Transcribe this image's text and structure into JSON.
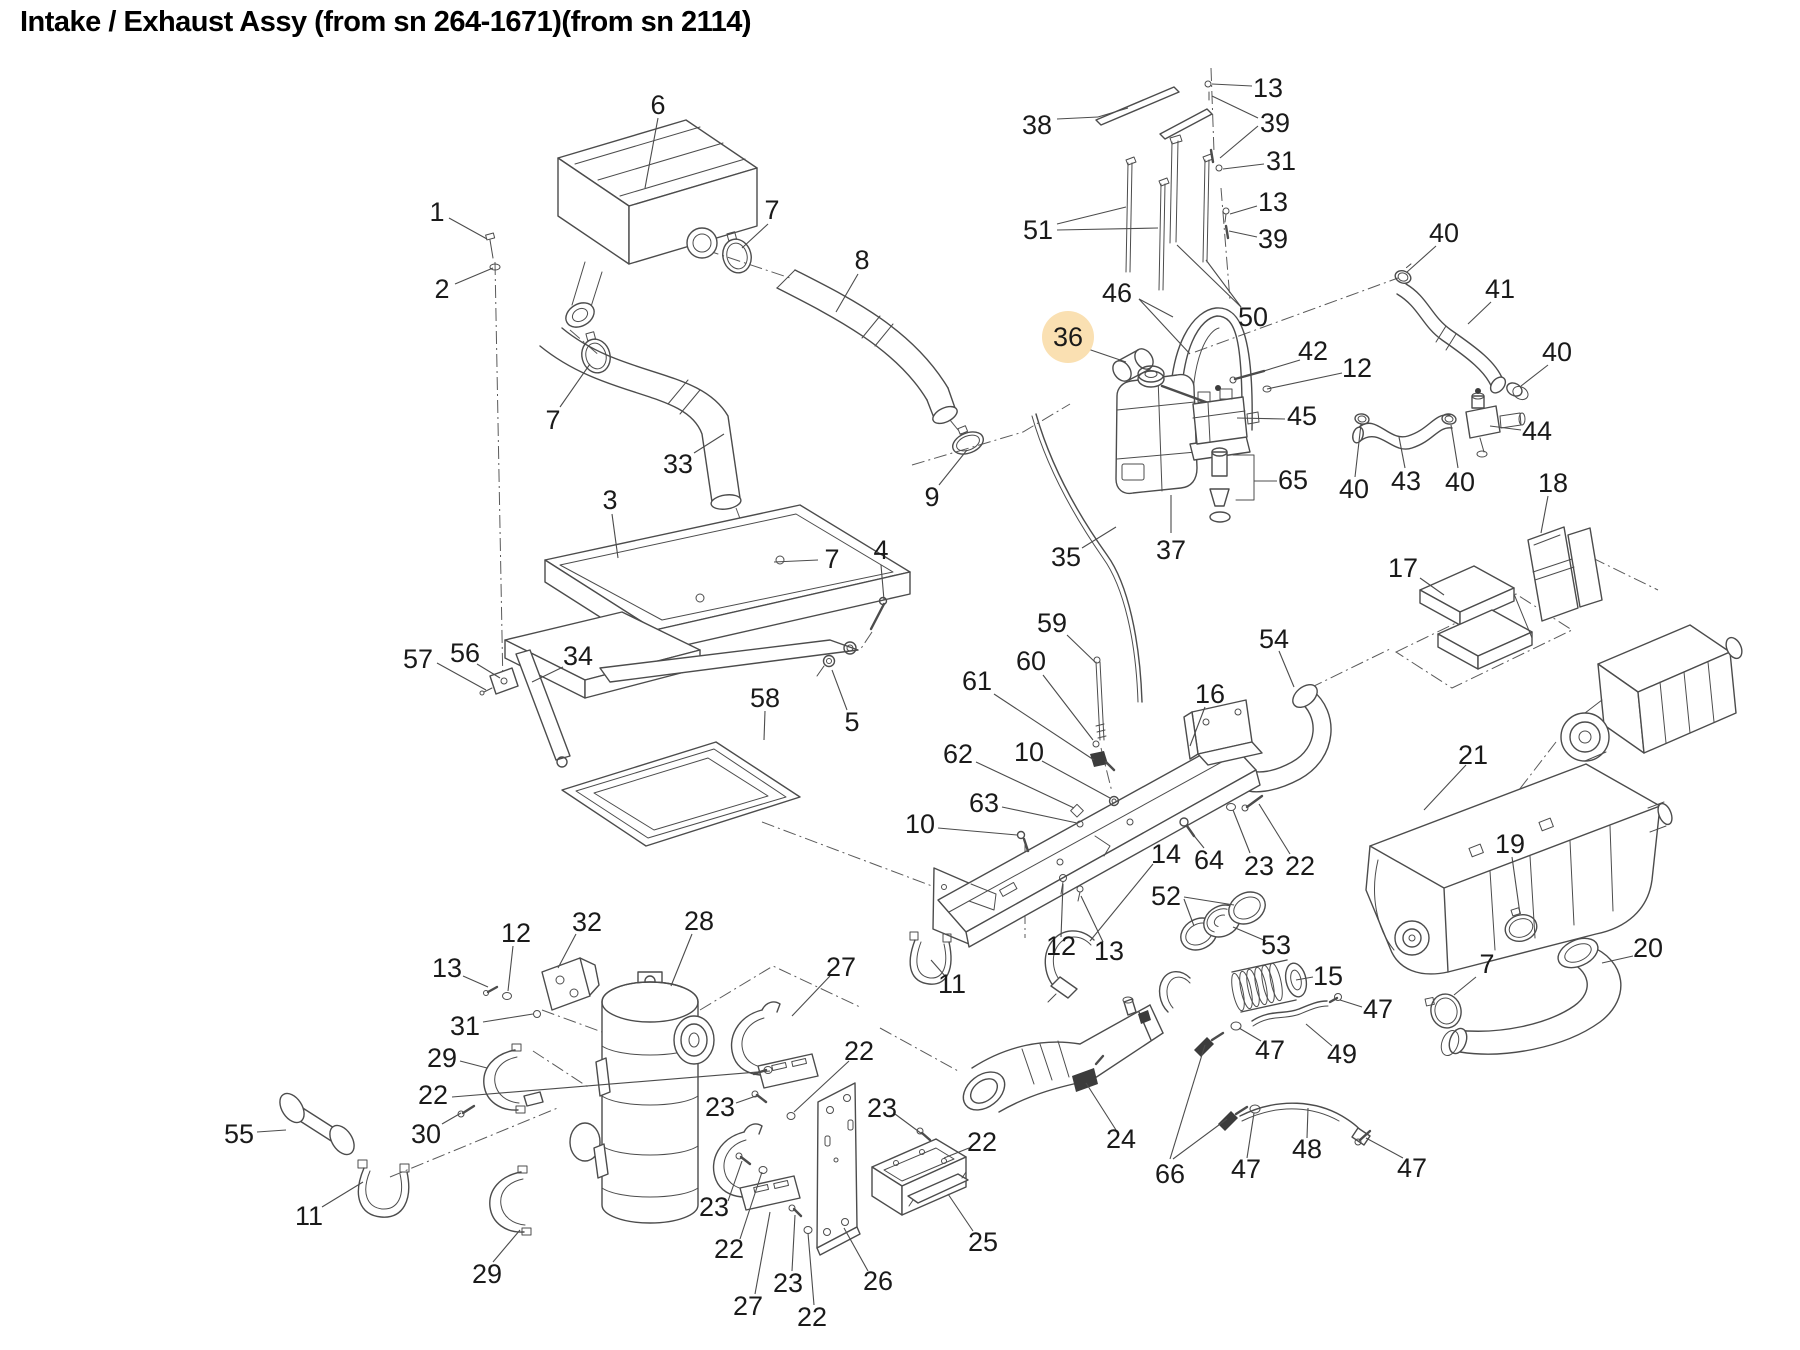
{
  "title": "Intake / Exhaust Assy (from sn 264-1671)(from sn 2114)",
  "colors": {
    "background": "#ffffff",
    "line_art": "#4c4c4c",
    "label_text": "#1a1a1a",
    "highlight_fill": "#fae0b2",
    "highlight_text": "#5d5e64"
  },
  "highlight": {
    "radius": 26
  },
  "callouts": [
    {
      "text": "6",
      "x": 658,
      "y": 105,
      "leaders": [
        [
          658,
          118,
          645,
          188
        ]
      ]
    },
    {
      "text": "1",
      "x": 437,
      "y": 212,
      "leaders": [
        [
          449,
          218,
          487,
          239
        ]
      ]
    },
    {
      "text": "2",
      "x": 442,
      "y": 289,
      "leaders": [
        [
          455,
          284,
          493,
          268
        ]
      ]
    },
    {
      "text": "7",
      "x": 772,
      "y": 210,
      "leaders": [
        [
          768,
          224,
          742,
          248
        ]
      ]
    },
    {
      "text": "8",
      "x": 862,
      "y": 260,
      "leaders": [
        [
          858,
          274,
          836,
          312
        ]
      ]
    },
    {
      "text": "7",
      "x": 553,
      "y": 420,
      "leaders": [
        [
          560,
          407,
          590,
          364
        ]
      ]
    },
    {
      "text": "33",
      "x": 678,
      "y": 464,
      "leaders": [
        [
          694,
          453,
          724,
          434
        ]
      ]
    },
    {
      "text": "3",
      "x": 610,
      "y": 500,
      "leaders": [
        [
          612,
          514,
          618,
          558
        ]
      ]
    },
    {
      "text": "57",
      "x": 418,
      "y": 659,
      "leaders": [
        [
          437,
          663,
          486,
          690
        ]
      ]
    },
    {
      "text": "56",
      "x": 465,
      "y": 653,
      "leaders": [
        [
          477,
          664,
          500,
          678
        ]
      ]
    },
    {
      "text": "34",
      "x": 578,
      "y": 656,
      "leaders": [
        [
          563,
          667,
          532,
          682
        ]
      ]
    },
    {
      "text": "58",
      "x": 765,
      "y": 698,
      "leaders": [
        [
          765,
          711,
          764,
          740
        ]
      ]
    },
    {
      "text": "5",
      "x": 852,
      "y": 722,
      "leaders": [
        [
          847,
          710,
          832,
          670
        ]
      ]
    },
    {
      "text": "4",
      "x": 881,
      "y": 550,
      "leaders": [
        [
          881,
          565,
          884,
          600
        ]
      ]
    },
    {
      "text": "7",
      "x": 832,
      "y": 559,
      "leaders": [
        [
          818,
          560,
          774,
          562
        ]
      ]
    },
    {
      "text": "9",
      "x": 932,
      "y": 497,
      "leaders": [
        [
          939,
          485,
          967,
          450
        ]
      ]
    },
    {
      "text": "38",
      "x": 1037,
      "y": 125,
      "leaders": [
        [
          1057,
          119,
          1098,
          117
        ],
        [
          1098,
          117,
          1128,
          108
        ]
      ]
    },
    {
      "text": "13",
      "x": 1268,
      "y": 88,
      "leaders": [
        [
          1252,
          86,
          1212,
          84
        ]
      ]
    },
    {
      "text": "39",
      "x": 1275,
      "y": 123,
      "leaders": [
        [
          1258,
          118,
          1212,
          96
        ],
        [
          1258,
          126,
          1220,
          158
        ]
      ]
    },
    {
      "text": "31",
      "x": 1281,
      "y": 161,
      "leaders": [
        [
          1264,
          164,
          1223,
          169
        ]
      ]
    },
    {
      "text": "13",
      "x": 1273,
      "y": 202,
      "leaders": [
        [
          1257,
          206,
          1230,
          214
        ]
      ]
    },
    {
      "text": "39",
      "x": 1273,
      "y": 239,
      "leaders": [
        [
          1257,
          237,
          1229,
          231
        ]
      ]
    },
    {
      "text": "51",
      "x": 1038,
      "y": 230,
      "leaders": [
        [
          1057,
          224,
          1126,
          207
        ],
        [
          1057,
          230,
          1158,
          228
        ]
      ]
    },
    {
      "text": "46",
      "x": 1117,
      "y": 293,
      "leaders": [
        [
          1139,
          299,
          1173,
          317
        ],
        [
          1139,
          299,
          1190,
          354
        ]
      ]
    },
    {
      "text": "50",
      "x": 1253,
      "y": 317,
      "leaders": [
        [
          1241,
          307,
          1206,
          260
        ],
        [
          1241,
          307,
          1177,
          245
        ]
      ]
    },
    {
      "text": "36",
      "x": 1068,
      "y": 337,
      "highlight": true,
      "leaders": [
        [
          1082,
          347,
          1126,
          362
        ]
      ]
    },
    {
      "text": "42",
      "x": 1313,
      "y": 351,
      "leaders": [
        [
          1300,
          360,
          1244,
          377
        ]
      ]
    },
    {
      "text": "12",
      "x": 1357,
      "y": 368,
      "leaders": [
        [
          1342,
          373,
          1267,
          389
        ]
      ]
    },
    {
      "text": "45",
      "x": 1302,
      "y": 416,
      "leaders": [
        [
          1285,
          419,
          1237,
          418
        ]
      ]
    },
    {
      "text": "65",
      "x": 1293,
      "y": 480,
      "leaders": [
        [
          1277,
          481,
          1254,
          481
        ]
      ]
    },
    {
      "text": "40",
      "x": 1354,
      "y": 489,
      "leaders": [
        [
          1355,
          477,
          1361,
          424
        ]
      ]
    },
    {
      "text": "35",
      "x": 1066,
      "y": 557,
      "leaders": [
        [
          1082,
          548,
          1116,
          527
        ]
      ]
    },
    {
      "text": "37",
      "x": 1171,
      "y": 550,
      "leaders": [
        [
          1171,
          533,
          1171,
          495
        ]
      ]
    },
    {
      "text": "40",
      "x": 1444,
      "y": 233,
      "leaders": [
        [
          1436,
          246,
          1407,
          272
        ]
      ]
    },
    {
      "text": "41",
      "x": 1500,
      "y": 289,
      "leaders": [
        [
          1491,
          302,
          1468,
          324
        ]
      ]
    },
    {
      "text": "40",
      "x": 1557,
      "y": 352,
      "leaders": [
        [
          1548,
          365,
          1521,
          386
        ]
      ]
    },
    {
      "text": "44",
      "x": 1537,
      "y": 431,
      "leaders": [
        [
          1521,
          430,
          1490,
          426
        ]
      ]
    },
    {
      "text": "43",
      "x": 1406,
      "y": 481,
      "leaders": [
        [
          1405,
          468,
          1399,
          437
        ]
      ]
    },
    {
      "text": "40",
      "x": 1460,
      "y": 482,
      "leaders": [
        [
          1458,
          468,
          1451,
          425
        ]
      ]
    },
    {
      "text": "17",
      "x": 1403,
      "y": 568,
      "leaders": [
        [
          1420,
          578,
          1444,
          595
        ]
      ]
    },
    {
      "text": "18",
      "x": 1553,
      "y": 483,
      "leaders": [
        [
          1548,
          496,
          1541,
          533
        ]
      ]
    },
    {
      "text": "54",
      "x": 1274,
      "y": 639,
      "leaders": [
        [
          1279,
          651,
          1294,
          687
        ]
      ]
    },
    {
      "text": "21",
      "x": 1473,
      "y": 755,
      "leaders": [
        [
          1466,
          765,
          1424,
          810
        ]
      ]
    },
    {
      "text": "19",
      "x": 1510,
      "y": 844,
      "leaders": [
        [
          1512,
          857,
          1520,
          914
        ]
      ]
    },
    {
      "text": "20",
      "x": 1648,
      "y": 948,
      "leaders": [
        [
          1633,
          956,
          1602,
          963
        ]
      ]
    },
    {
      "text": "7",
      "x": 1487,
      "y": 964,
      "leaders": [
        [
          1476,
          977,
          1454,
          995
        ]
      ]
    },
    {
      "text": "47",
      "x": 1378,
      "y": 1009,
      "leaders": [
        [
          1362,
          1007,
          1340,
          1000
        ]
      ]
    },
    {
      "text": "15",
      "x": 1328,
      "y": 976,
      "leaders": [
        [
          1313,
          977,
          1296,
          980
        ]
      ]
    },
    {
      "text": "49",
      "x": 1342,
      "y": 1054,
      "leaders": [
        [
          1332,
          1046,
          1306,
          1024
        ]
      ]
    },
    {
      "text": "47",
      "x": 1270,
      "y": 1050,
      "leaders": [
        [
          1261,
          1041,
          1239,
          1028
        ]
      ]
    },
    {
      "text": "24",
      "x": 1121,
      "y": 1139,
      "leaders": [
        [
          1116,
          1130,
          1086,
          1083
        ]
      ]
    },
    {
      "text": "66",
      "x": 1170,
      "y": 1174,
      "leaders": [
        [
          1170,
          1159,
          1205,
          1045
        ],
        [
          1173,
          1159,
          1227,
          1119
        ]
      ]
    },
    {
      "text": "47",
      "x": 1246,
      "y": 1169,
      "leaders": [
        [
          1247,
          1158,
          1254,
          1113
        ]
      ]
    },
    {
      "text": "48",
      "x": 1307,
      "y": 1149,
      "leaders": [
        [
          1307,
          1138,
          1308,
          1108
        ]
      ]
    },
    {
      "text": "47",
      "x": 1412,
      "y": 1168,
      "leaders": [
        [
          1403,
          1158,
          1366,
          1138
        ]
      ]
    },
    {
      "text": "59",
      "x": 1052,
      "y": 623,
      "leaders": [
        [
          1067,
          635,
          1095,
          662
        ]
      ]
    },
    {
      "text": "60",
      "x": 1031,
      "y": 661,
      "leaders": [
        [
          1043,
          675,
          1093,
          740
        ]
      ]
    },
    {
      "text": "61",
      "x": 977,
      "y": 681,
      "leaders": [
        [
          994,
          694,
          1094,
          760
        ]
      ]
    },
    {
      "text": "16",
      "x": 1210,
      "y": 694,
      "leaders": [
        [
          1205,
          707,
          1190,
          746
        ]
      ]
    },
    {
      "text": "62",
      "x": 958,
      "y": 754,
      "leaders": [
        [
          976,
          762,
          1074,
          808
        ]
      ]
    },
    {
      "text": "10",
      "x": 1029,
      "y": 752,
      "leaders": [
        [
          1042,
          761,
          1110,
          798
        ]
      ]
    },
    {
      "text": "63",
      "x": 984,
      "y": 803,
      "leaders": [
        [
          1002,
          807,
          1077,
          823
        ]
      ]
    },
    {
      "text": "10",
      "x": 920,
      "y": 824,
      "leaders": [
        [
          938,
          828,
          1017,
          835
        ]
      ]
    },
    {
      "text": "14",
      "x": 1166,
      "y": 854,
      "leaders": [
        [
          1153,
          864,
          1090,
          941
        ]
      ]
    },
    {
      "text": "64",
      "x": 1209,
      "y": 860,
      "leaders": [
        [
          1204,
          848,
          1187,
          827
        ]
      ]
    },
    {
      "text": "23",
      "x": 1259,
      "y": 866,
      "leaders": [
        [
          1250,
          853,
          1233,
          810
        ]
      ]
    },
    {
      "text": "22",
      "x": 1300,
      "y": 866,
      "leaders": [
        [
          1290,
          854,
          1259,
          804
        ]
      ]
    },
    {
      "text": "52",
      "x": 1166,
      "y": 896,
      "leaders": [
        [
          1184,
          897,
          1234,
          905
        ],
        [
          1184,
          899,
          1194,
          926
        ]
      ]
    },
    {
      "text": "53",
      "x": 1276,
      "y": 945,
      "leaders": [
        [
          1266,
          941,
          1233,
          927
        ]
      ]
    },
    {
      "text": "12",
      "x": 1061,
      "y": 946,
      "leaders": [
        [
          1061,
          937,
          1063,
          884
        ]
      ]
    },
    {
      "text": "13",
      "x": 1109,
      "y": 951,
      "leaders": [
        [
          1103,
          942,
          1081,
          896
        ]
      ]
    },
    {
      "text": "11",
      "x": 952,
      "y": 984,
      "leaders": [
        [
          945,
          976,
          931,
          960
        ]
      ]
    },
    {
      "text": "12",
      "x": 516,
      "y": 933,
      "leaders": [
        [
          513,
          946,
          508,
          991
        ]
      ]
    },
    {
      "text": "32",
      "x": 587,
      "y": 922,
      "leaders": [
        [
          576,
          934,
          558,
          968
        ]
      ]
    },
    {
      "text": "13",
      "x": 447,
      "y": 968,
      "leaders": [
        [
          463,
          976,
          488,
          987
        ]
      ]
    },
    {
      "text": "31",
      "x": 465,
      "y": 1026,
      "leaders": [
        [
          483,
          1022,
          533,
          1014
        ]
      ]
    },
    {
      "text": "29",
      "x": 442,
      "y": 1058,
      "leaders": [
        [
          460,
          1061,
          487,
          1068
        ]
      ]
    },
    {
      "text": "22",
      "x": 433,
      "y": 1095,
      "leaders": [
        [
          452,
          1097,
          770,
          1071
        ]
      ]
    },
    {
      "text": "30",
      "x": 426,
      "y": 1134,
      "leaders": [
        [
          442,
          1124,
          461,
          1113
        ]
      ]
    },
    {
      "text": "55",
      "x": 239,
      "y": 1134,
      "leaders": [
        [
          257,
          1132,
          286,
          1130
        ]
      ]
    },
    {
      "text": "11",
      "x": 309,
      "y": 1216,
      "leaders": [
        [
          322,
          1207,
          363,
          1182
        ]
      ]
    },
    {
      "text": "29",
      "x": 487,
      "y": 1274,
      "leaders": [
        [
          493,
          1262,
          520,
          1230
        ]
      ]
    },
    {
      "text": "28",
      "x": 699,
      "y": 921,
      "leaders": [
        [
          692,
          934,
          671,
          986
        ]
      ]
    },
    {
      "text": "27",
      "x": 841,
      "y": 967,
      "leaders": [
        [
          830,
          976,
          792,
          1016
        ]
      ]
    },
    {
      "text": "22",
      "x": 859,
      "y": 1051,
      "leaders": [
        [
          849,
          1061,
          794,
          1112
        ]
      ]
    },
    {
      "text": "23",
      "x": 720,
      "y": 1107,
      "leaders": [
        [
          736,
          1103,
          756,
          1096
        ]
      ]
    },
    {
      "text": "23",
      "x": 882,
      "y": 1108,
      "leaders": [
        [
          895,
          1114,
          922,
          1134
        ]
      ]
    },
    {
      "text": "22",
      "x": 982,
      "y": 1142,
      "leaders": [
        [
          969,
          1148,
          944,
          1158
        ]
      ]
    },
    {
      "text": "23",
      "x": 714,
      "y": 1207,
      "leaders": [
        [
          728,
          1201,
          742,
          1161
        ]
      ]
    },
    {
      "text": "22",
      "x": 729,
      "y": 1249,
      "leaders": [
        [
          740,
          1239,
          762,
          1172
        ]
      ]
    },
    {
      "text": "27",
      "x": 748,
      "y": 1306,
      "leaders": [
        [
          755,
          1294,
          770,
          1212
        ]
      ]
    },
    {
      "text": "23",
      "x": 788,
      "y": 1283,
      "leaders": [
        [
          792,
          1271,
          795,
          1215
        ]
      ]
    },
    {
      "text": "22",
      "x": 812,
      "y": 1317,
      "leaders": [
        [
          814,
          1305,
          808,
          1233
        ]
      ]
    },
    {
      "text": "26",
      "x": 878,
      "y": 1281,
      "leaders": [
        [
          868,
          1271,
          844,
          1228
        ]
      ]
    },
    {
      "text": "25",
      "x": 983,
      "y": 1242,
      "leaders": [
        [
          973,
          1231,
          948,
          1194
        ]
      ]
    }
  ]
}
